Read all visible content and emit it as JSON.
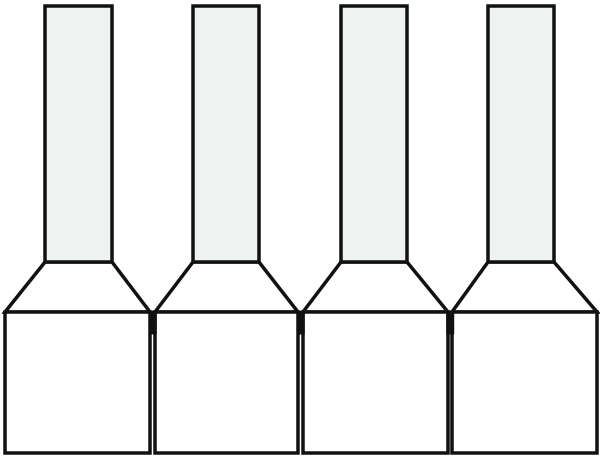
{
  "figure": {
    "description": "Line drawing of four identical wire-end ferrules (crimp sleeves) in a row",
    "canvas": {
      "width": 600,
      "height": 464,
      "background": "#ffffff"
    },
    "style": {
      "outline_color": "#111111",
      "outline_width": 3.5,
      "tube_fill": "#eef2f0",
      "body_fill": "#ffffff",
      "joint_color": "#111111"
    },
    "geometry": {
      "tube_top_y": 6,
      "tube_bottom_y": 262,
      "box_top_y": 312,
      "box_bottom_y": 453,
      "joint_top_y": 310.5,
      "joint_height": 24,
      "joint_width": 8
    },
    "ferrules": [
      {
        "name": "ferrule-1",
        "tube_x1": 45,
        "tube_x2": 112,
        "box_x1": 5,
        "box_x2": 150
      },
      {
        "name": "ferrule-2",
        "tube_x1": 193,
        "tube_x2": 259,
        "box_x1": 155,
        "box_x2": 298
      },
      {
        "name": "ferrule-3",
        "tube_x1": 341,
        "tube_x2": 407,
        "box_x1": 303,
        "box_x2": 448
      },
      {
        "name": "ferrule-4",
        "tube_x1": 488,
        "tube_x2": 554,
        "box_x1": 452,
        "box_x2": 597
      }
    ],
    "joints_x": [
      152.8,
      300.8,
      450.2
    ]
  }
}
